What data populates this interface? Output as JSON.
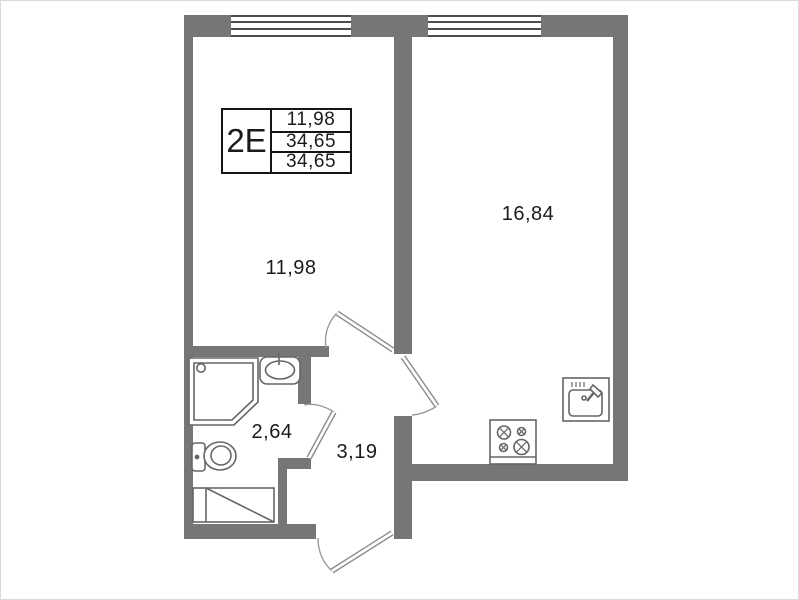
{
  "title_block": {
    "type_label": "2Е",
    "values": [
      "11,98",
      "34,65",
      "34,65"
    ]
  },
  "rooms": {
    "living": {
      "label": "11,98"
    },
    "kitchen_living": {
      "label": "16,84"
    },
    "bathroom": {
      "label": "2,64"
    },
    "hallway": {
      "label": "3,19"
    }
  },
  "icons": [
    "window-icon",
    "door-swing-icon",
    "shower-cabin-icon",
    "washbasin-icon",
    "toilet-icon",
    "laundry-box-icon",
    "stove-icon",
    "kitchen-sink-icon"
  ],
  "colors": {
    "wall": "#767676",
    "fixture_line": "#666666",
    "door_line": "#8a8a8a",
    "text": "#1b1b1b"
  }
}
